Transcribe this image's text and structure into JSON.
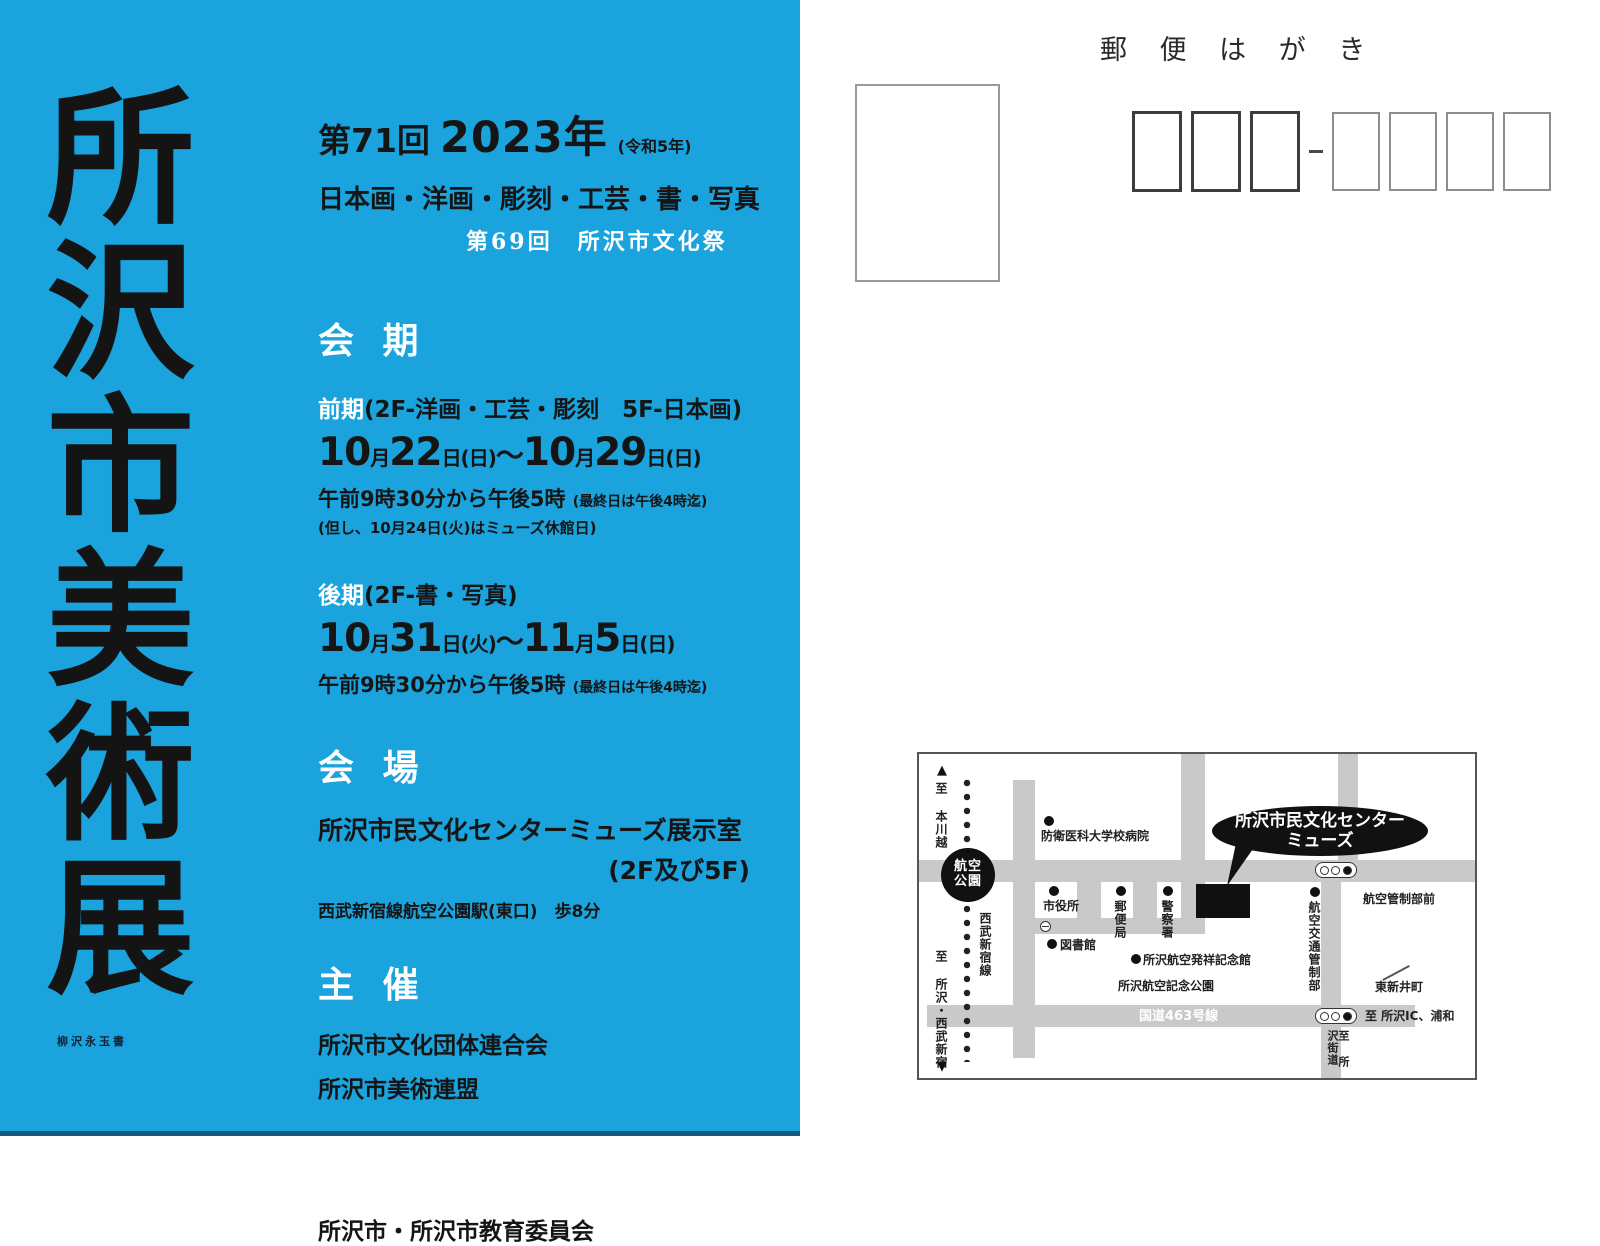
{
  "flyer": {
    "calligraphy_title": "所沢市美術展",
    "artist_signature": "柳沢永玉書",
    "edition": "第71回",
    "year": "2023年",
    "era_note": "(令和5年)",
    "genres": "日本画・洋画・彫刻・工芸・書・写真",
    "culture_festival": "第69回　所沢市文化祭",
    "period": {
      "heading": "会 期",
      "first": {
        "label": "前期",
        "floors": "(2F-洋画・工芸・彫刻　5F-日本画)",
        "date": {
          "m1": "10",
          "mu1": "月",
          "d1": "22",
          "du1": "日(日)",
          "tilde": "〜",
          "m2": "10",
          "mu2": "月",
          "d2": "29",
          "du2": "日(日)"
        },
        "time": "午前9時30分から午後5時",
        "time_note": "(最終日は午後4時迄)",
        "closed_note": "(但し、10月24日(火)はミューズ休館日)"
      },
      "second": {
        "label": "後期",
        "floors": "(2F-書・写真)",
        "date": {
          "m1": "10",
          "mu1": "月",
          "d1": "31",
          "du1": "日(火)",
          "tilde": "〜",
          "m2": "11",
          "mu2": "月",
          "d2": "5",
          "du2": "日(日)"
        },
        "time": "午前9時30分から午後5時",
        "time_note": "(最終日は午後4時迄)"
      }
    },
    "venue": {
      "heading": "会 場",
      "name": "所沢市民文化センターミューズ展示室",
      "floors": "(2F及び5F)",
      "access": "西武新宿線航空公園駅(東口)　歩8分"
    },
    "organizer": {
      "heading": "主 催",
      "line1": "所沢市文化団体連合会",
      "line2": "所沢市美術連盟"
    },
    "support": {
      "heading": "後 援",
      "line1": "所沢市・所沢市教育委員会"
    }
  },
  "postcard": {
    "header": "郵 便 は が き"
  },
  "map": {
    "balloon": {
      "line1": "所沢市民文化センター",
      "line2": "ミューズ"
    },
    "station": {
      "line1": "航空",
      "line2": "公園"
    },
    "railway": {
      "to_north": "至 本川越",
      "to_south": "至 所沢・西武新宿",
      "line_name": "西武新宿線",
      "arrow_up": "▲",
      "arrow_down": "▼"
    },
    "labels": {
      "hospital": "防衛医科大学校病院",
      "city_hall": "市役所",
      "library": "図書館",
      "post_office": "郵便局",
      "police": "警察署",
      "aviation_museum": "所沢航空発祥記念館",
      "memorial_park": "所沢航空記念公園",
      "route463": "国道463号線",
      "atc_center": "航空交通管制部",
      "atc_front": "航空管制部前",
      "higashiarai": "東新井町",
      "to_ic": "至 所沢IC、浦和",
      "kaido": "至 所沢街道"
    }
  },
  "colors": {
    "flyer_blue": "#1aa3dd",
    "road_gray": "#c9c9c9",
    "ink": "#141414"
  }
}
